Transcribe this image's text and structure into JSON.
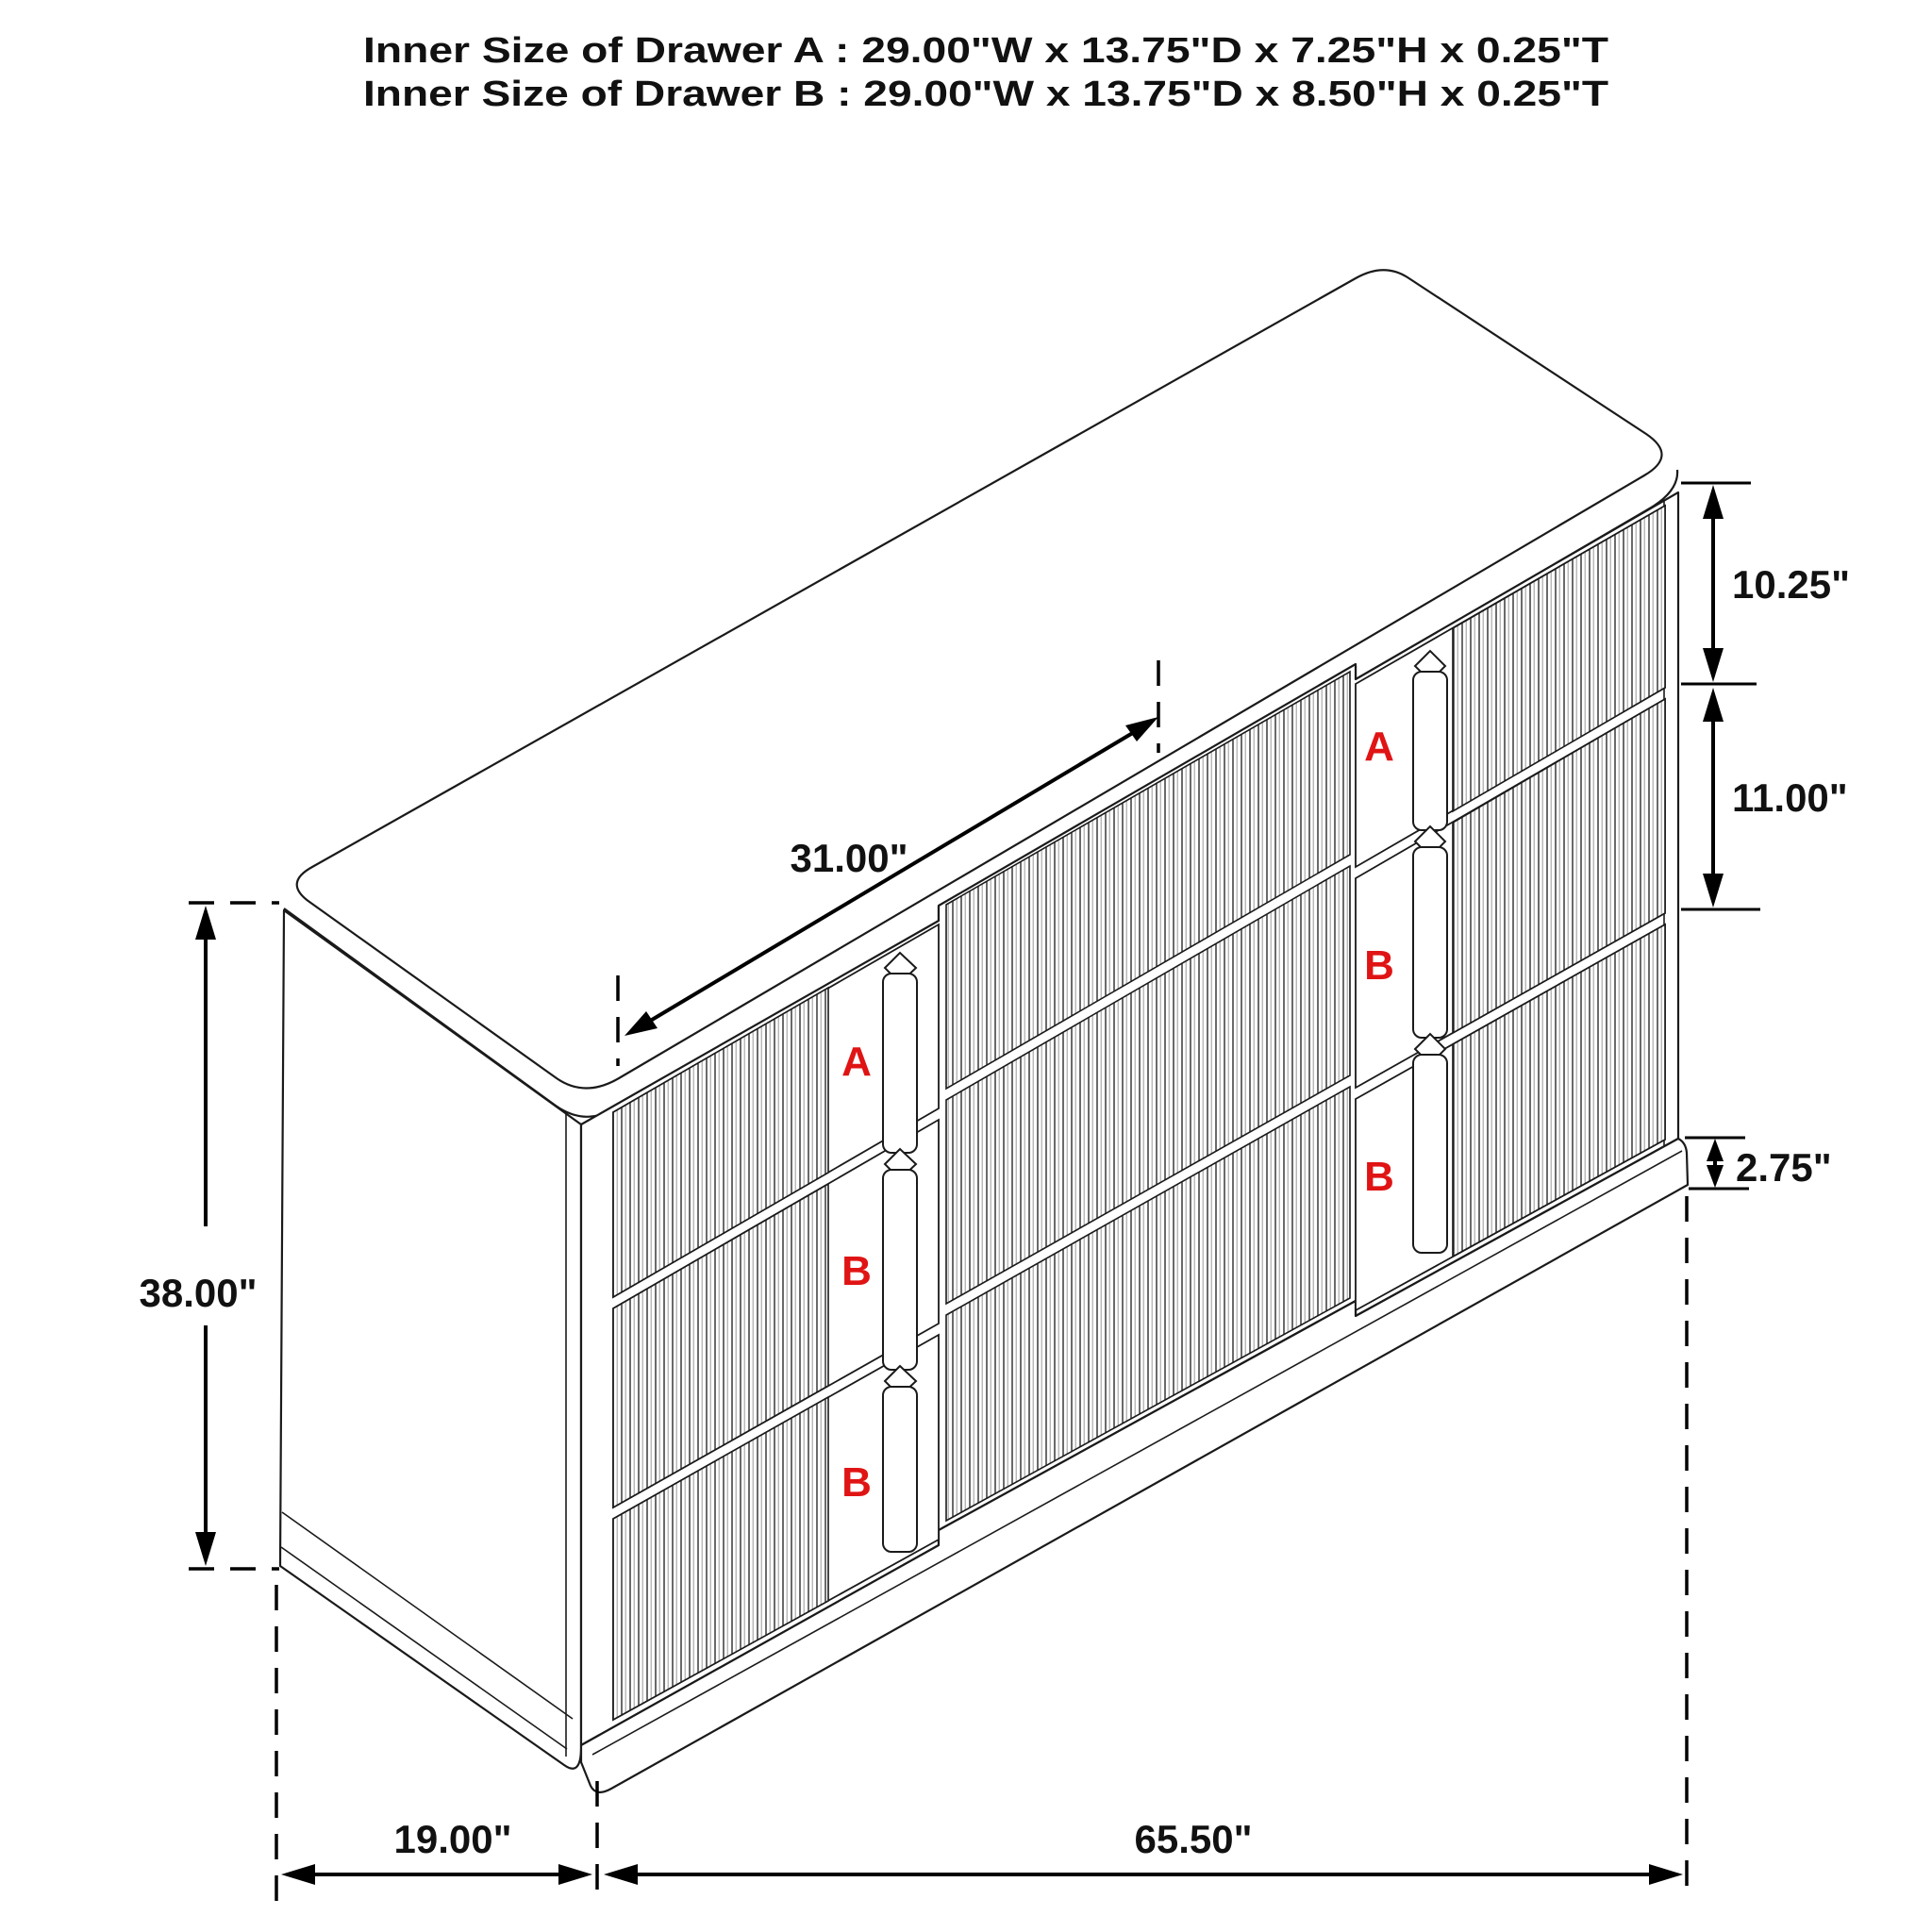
{
  "title": {
    "line1": "Inner Size of Drawer A : 29.00\"W x 13.75\"D x 7.25\"H x 0.25\"T",
    "line2": "Inner Size of Drawer B : 29.00\"W x 13.75\"D x 8.50\"H x 0.25\"T"
  },
  "dimensions": {
    "middle_top_width": "31.00\"",
    "top_drawer_height": "10.25\"",
    "middle_drawer_height": "11.00\"",
    "base_height": "2.75\"",
    "overall_height": "38.00\"",
    "depth": "19.00\"",
    "overall_width": "65.50\""
  },
  "drawer_labels": {
    "left_bank": [
      "A",
      "B",
      "B"
    ],
    "right_bank": [
      "A",
      "B",
      "B"
    ]
  },
  "colors": {
    "label_red": "#e01414",
    "line_black": "#111111",
    "background": "#ffffff"
  }
}
